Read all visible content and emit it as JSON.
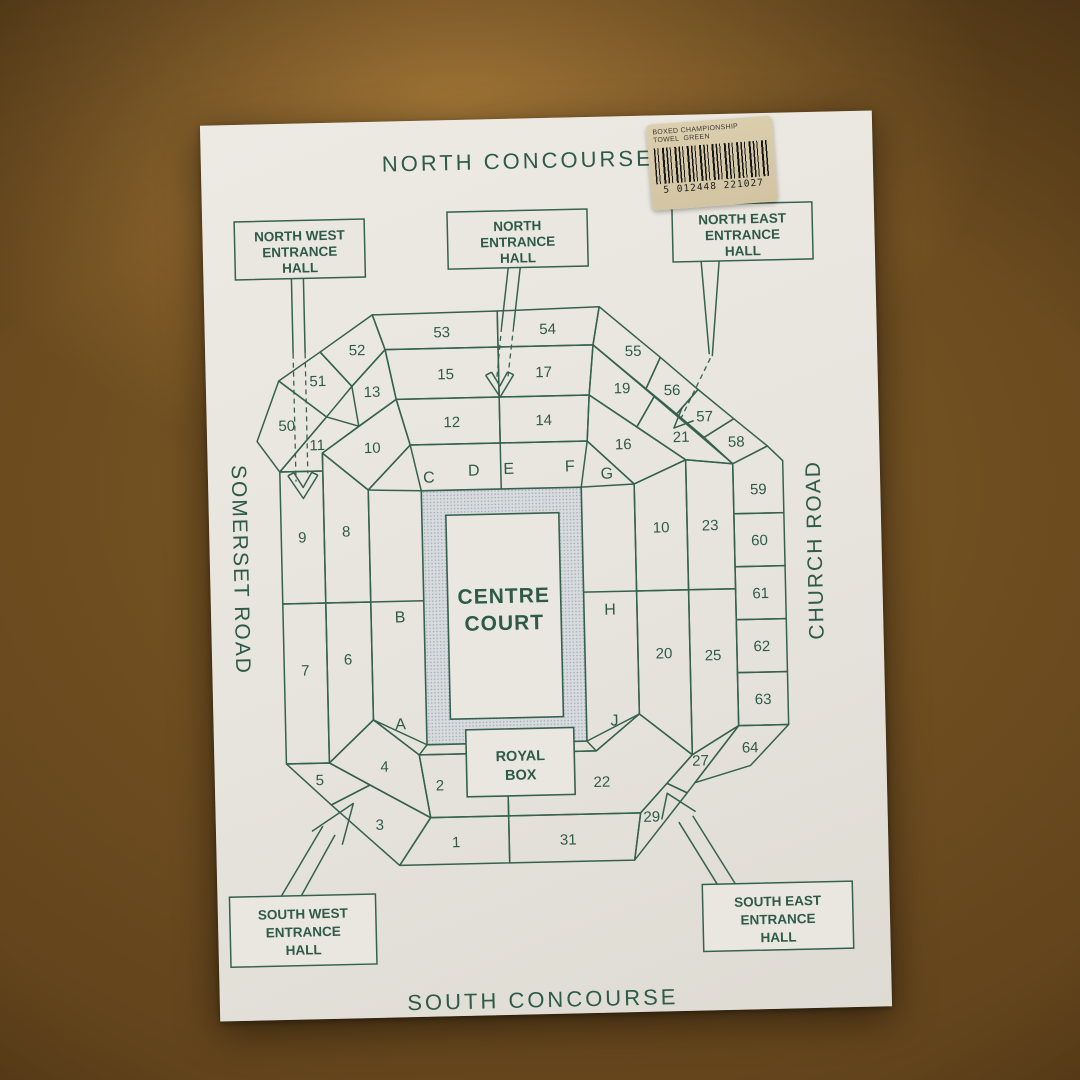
{
  "sticker": {
    "line1": "BOXED CHAMPIONSHIP",
    "line2": "TOWEL  GREEN",
    "barcode_number": "5 012448 221027"
  },
  "map": {
    "concourse_north": "NORTH CONCOURSE",
    "concourse_south": "SOUTH CONCOURSE",
    "road_west": "SOMERSET ROAD",
    "road_east": "CHURCH ROAD",
    "entrances": {
      "north_west": [
        "NORTH WEST",
        "ENTRANCE",
        "HALL"
      ],
      "north": [
        "NORTH",
        "ENTRANCE",
        "HALL"
      ],
      "north_east": [
        "NORTH EAST",
        "ENTRANCE",
        "HALL"
      ],
      "south_west": [
        "SOUTH WEST",
        "ENTRANCE",
        "HALL"
      ],
      "south_east": [
        "SOUTH EAST",
        "ENTRANCE",
        "HALL"
      ]
    },
    "court": {
      "line1": "CENTRE",
      "line2": "COURT"
    },
    "royal_box": {
      "line1": "ROYAL",
      "line2": "BOX"
    },
    "gangways": {
      "A": "A",
      "B": "B",
      "C": "C",
      "D": "D",
      "E": "E",
      "F": "F",
      "G": "G",
      "H": "H",
      "J": "J"
    },
    "sections": {
      "n1": "1",
      "n2": "2",
      "n3": "3",
      "n4": "4",
      "n5": "5",
      "n6": "6",
      "n7": "7",
      "n8": "8",
      "n9": "9",
      "n10a": "10",
      "n11": "11",
      "n12": "12",
      "n13": "13",
      "n14": "14",
      "n15": "15",
      "n16": "16",
      "n17": "17",
      "n10b": "10",
      "n19": "19",
      "n20": "20",
      "n21": "21",
      "n22": "22",
      "n23": "23",
      "n25": "25",
      "n27": "27",
      "n29": "29",
      "n31": "31",
      "n50": "50",
      "n51": "51",
      "n52": "52",
      "n53": "53",
      "n54": "54",
      "n55": "55",
      "n56": "56",
      "n57": "57",
      "n58": "58",
      "n59": "59",
      "n60": "60",
      "n61": "61",
      "n62": "62",
      "n63": "63",
      "n64": "64"
    }
  },
  "colors": {
    "ink": "#2e5a49",
    "paper": "#eae7e0",
    "wood": "#7a5827",
    "sticker_bg": "#d8cbab",
    "court_band": "#d7dbde"
  }
}
